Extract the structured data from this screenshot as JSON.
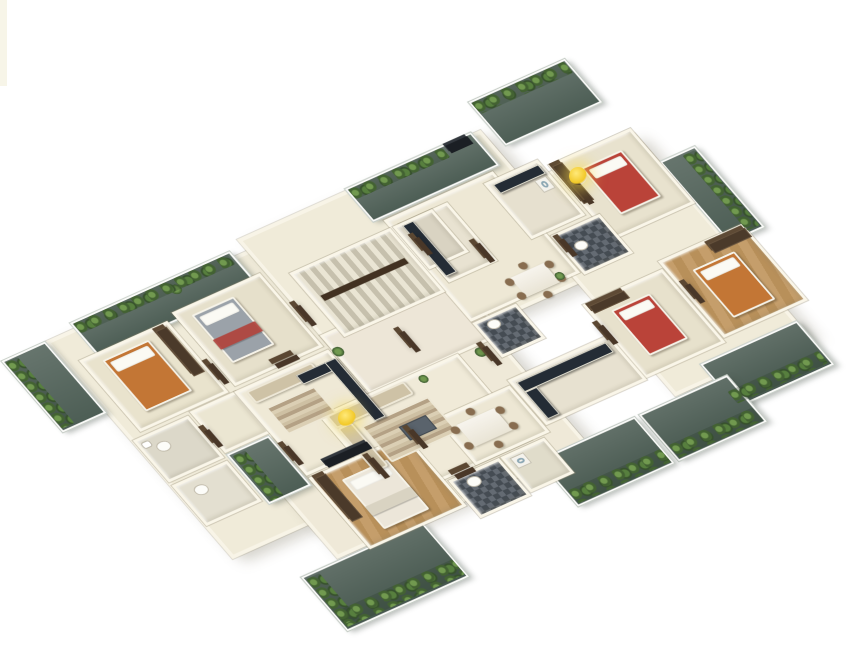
{
  "scene": {
    "kind": "isometric-3d-floor-plan-rendering",
    "palette": {
      "background": "#ffffff",
      "wall": "#f8f4e6",
      "floor_cream": "#f0ebd8",
      "balcony_deck": "#46584f",
      "foliage": "#4e7637",
      "wood_floor": "#c39a63",
      "counter_dark": "#232c36",
      "bed_red": "#c24136",
      "bed_orange": "#c9752e",
      "bed_grey": "#9aa2aa",
      "door_brown": "#4a3726",
      "light_accent": "#f2c928"
    },
    "projection": {
      "a": 0.84,
      "b": -0.378,
      "c": 0.647,
      "d": 0.75,
      "tx": -41,
      "ty": 323
    },
    "blocks": [
      {
        "name": "slab-left",
        "kind": "base",
        "x": 60,
        "y": 55,
        "w": 250,
        "h": 290,
        "floor": "#f0ebd8"
      },
      {
        "name": "slab-top",
        "kind": "base",
        "x": 300,
        "y": 40,
        "w": 290,
        "h": 190,
        "floor": "#f0ebd8"
      },
      {
        "name": "slab-right",
        "kind": "base",
        "x": 560,
        "y": 110,
        "w": 160,
        "h": 270,
        "floor": "#f0ebd8"
      },
      {
        "name": "slab-bottom",
        "kind": "base",
        "x": 150,
        "y": 240,
        "w": 300,
        "h": 150,
        "floor": "#efe9d6"
      },
      {
        "name": "balcony-top",
        "kind": "balcony",
        "x": 600,
        "y": 8,
        "w": 115,
        "h": 58,
        "floor": "#4c5e55"
      },
      {
        "name": "balcony-upper-left-west",
        "kind": "balcony",
        "x": 95,
        "y": 48,
        "w": 190,
        "h": 44,
        "floor": "#4c5e55"
      },
      {
        "name": "balcony-upper-left-east",
        "kind": "balcony",
        "x": 430,
        "y": 38,
        "w": 150,
        "h": 44,
        "floor": "#4c5e55"
      },
      {
        "name": "balcony-left",
        "kind": "balcony",
        "x": 8,
        "y": 55,
        "w": 52,
        "h": 95,
        "floor": "#4c5e55"
      },
      {
        "name": "balcony-right-upper",
        "kind": "balcony",
        "x": 720,
        "y": 148,
        "w": 42,
        "h": 108,
        "floor": "#4c5e55"
      },
      {
        "name": "balcony-right",
        "kind": "balcony",
        "x": 605,
        "y": 360,
        "w": 115,
        "h": 58,
        "floor": "#46584f"
      },
      {
        "name": "balcony-lower-right-east",
        "kind": "balcony",
        "x": 515,
        "y": 382,
        "w": 105,
        "h": 62,
        "floor": "#46584f"
      },
      {
        "name": "balcony-lower-right-west",
        "kind": "balcony",
        "x": 395,
        "y": 382,
        "w": 115,
        "h": 62,
        "floor": "#46584f"
      },
      {
        "name": "balcony-bottom",
        "kind": "balcony",
        "x": 105,
        "y": 392,
        "w": 145,
        "h": 72,
        "floor": "#46584f"
      },
      {
        "name": "balcony-niche",
        "kind": "balcony",
        "x": 132,
        "y": 242,
        "w": 50,
        "h": 66,
        "floor": "#4c5e55"
      },
      {
        "name": "corridor",
        "kind": "room",
        "x": 300,
        "y": 168,
        "w": 160,
        "h": 78,
        "floor": "#eee6d6"
      },
      {
        "name": "hall-top",
        "kind": "room",
        "x": 440,
        "y": 85,
        "w": 130,
        "h": 135,
        "floor": "#eee8d3"
      },
      {
        "name": "entry-left",
        "kind": "room",
        "x": 132,
        "y": 185,
        "w": 55,
        "h": 55,
        "floor": "#ece6d0"
      },
      {
        "name": "living-room-1",
        "kind": "room",
        "x": 185,
        "y": 185,
        "w": 112,
        "h": 112,
        "floor": "#efe9d4"
      },
      {
        "name": "living-room-2",
        "kind": "room",
        "x": 240,
        "y": 245,
        "w": 165,
        "h": 115,
        "floor": "#f0ead6"
      },
      {
        "name": "dining-room",
        "kind": "room",
        "x": 338,
        "y": 298,
        "w": 88,
        "h": 62,
        "floor": "#ede7d2"
      },
      {
        "name": "bedroom-1",
        "kind": "room",
        "x": 75,
        "y": 88,
        "w": 105,
        "h": 95,
        "floor": "#eae3cb"
      },
      {
        "name": "bedroom-2",
        "kind": "room",
        "x": 190,
        "y": 82,
        "w": 105,
        "h": 98,
        "floor": "#e7e0c9"
      },
      {
        "name": "bedroom-3",
        "kind": "room",
        "x": 185,
        "y": 300,
        "w": 115,
        "h": 95,
        "tex": "wood"
      },
      {
        "name": "bedroom-4",
        "kind": "room",
        "x": 622,
        "y": 103,
        "w": 98,
        "h": 100,
        "floor": "#e9e2cc"
      },
      {
        "name": "bedroom-5",
        "kind": "room",
        "x": 645,
        "y": 243,
        "w": 100,
        "h": 102,
        "tex": "wood"
      },
      {
        "name": "bedroom-6",
        "kind": "room",
        "x": 548,
        "y": 252,
        "w": 95,
        "h": 98,
        "floor": "#e8e1ca"
      },
      {
        "name": "kitchen-top-1",
        "kind": "room",
        "x": 450,
        "y": 95,
        "w": 58,
        "h": 78,
        "floor": "#e8e2cf"
      },
      {
        "name": "kitchen-top-2",
        "kind": "room",
        "x": 553,
        "y": 93,
        "w": 64,
        "h": 74,
        "floor": "#e6e0cd"
      },
      {
        "name": "kitchen-right",
        "kind": "room",
        "x": 428,
        "y": 292,
        "w": 120,
        "h": 60,
        "floor": "#e7e1ce"
      },
      {
        "name": "bathroom-1",
        "kind": "room",
        "x": 62,
        "y": 188,
        "w": 66,
        "h": 56,
        "floor": "#dcd8c8"
      },
      {
        "name": "bathroom-2",
        "kind": "room",
        "x": 62,
        "y": 248,
        "w": 66,
        "h": 54,
        "floor": "#e3dfcf"
      },
      {
        "name": "bathroom-3",
        "kind": "room",
        "x": 303,
        "y": 363,
        "w": 60,
        "h": 50,
        "tex": "tile"
      },
      {
        "name": "utility-room",
        "kind": "room",
        "x": 365,
        "y": 363,
        "w": 52,
        "h": 47,
        "floor": "#e0dcc9"
      },
      {
        "name": "bathroom-4",
        "kind": "room",
        "x": 572,
        "y": 172,
        "w": 58,
        "h": 52,
        "tex": "tile"
      },
      {
        "name": "bathroom-5",
        "kind": "room",
        "x": 440,
        "y": 222,
        "w": 52,
        "h": 46,
        "tex": "tile"
      },
      {
        "name": "stair-core",
        "kind": "room",
        "x": 320,
        "y": 95,
        "w": 120,
        "h": 85,
        "tex": "stairs"
      },
      {
        "name": "lift",
        "kind": "room",
        "x": 443,
        "y": 95,
        "w": 47,
        "h": 57,
        "floor": "#d9d3c1"
      }
    ],
    "furniture": [
      {
        "name": "bed-orange-west",
        "kind": "bed",
        "x": 95,
        "y": 98,
        "w": 55,
        "h": 68,
        "color": "#c9752e"
      },
      {
        "name": "bed-grey",
        "kind": "bed",
        "x": 205,
        "y": 93,
        "w": 50,
        "h": 64,
        "color": "#9aa2aa"
      },
      {
        "name": "bed-grey-throw",
        "kind": "throw",
        "x": 205,
        "y": 126,
        "w": 50,
        "h": 13,
        "color": "#b8413a"
      },
      {
        "name": "bed-red-north",
        "kind": "bed",
        "x": 648,
        "y": 120,
        "w": 48,
        "h": 62,
        "color": "#c24136"
      },
      {
        "name": "bed-orange-east",
        "kind": "bed",
        "x": 668,
        "y": 266,
        "w": 50,
        "h": 64,
        "color": "#c9752e"
      },
      {
        "name": "bed-red-south",
        "kind": "bed",
        "x": 568,
        "y": 270,
        "w": 46,
        "h": 60,
        "color": "#c24136"
      },
      {
        "name": "bed-white",
        "kind": "bed",
        "x": 212,
        "y": 316,
        "w": 54,
        "h": 66,
        "color": "#ece6d8"
      },
      {
        "name": "bed-white-throw",
        "kind": "throw",
        "x": 212,
        "y": 352,
        "w": 54,
        "h": 12,
        "color": "#d9d2bf"
      },
      {
        "name": "wardrobe",
        "kind": "wardrobe",
        "x": 162,
        "y": 93,
        "w": 13,
        "h": 60
      },
      {
        "name": "wardrobe",
        "kind": "wardrobe",
        "x": 190,
        "y": 303,
        "w": 13,
        "h": 58
      },
      {
        "name": "wardrobe",
        "kind": "wardrobe",
        "x": 700,
        "y": 248,
        "w": 44,
        "h": 12
      },
      {
        "name": "wardrobe",
        "kind": "wardrobe",
        "x": 552,
        "y": 256,
        "w": 42,
        "h": 10
      },
      {
        "name": "wardrobe",
        "kind": "wardrobe",
        "x": 624,
        "y": 106,
        "w": 12,
        "h": 50
      },
      {
        "name": "sofa",
        "kind": "sofa",
        "x": 195,
        "y": 190,
        "w": 78,
        "h": 16
      },
      {
        "name": "sofa-l-back",
        "kind": "sofa",
        "x": 246,
        "y": 248,
        "w": 92,
        "h": 17
      },
      {
        "name": "sofa-l-arm",
        "kind": "sofa",
        "x": 246,
        "y": 265,
        "w": 17,
        "h": 58
      },
      {
        "name": "rug",
        "kind": "rug",
        "x": 200,
        "y": 214,
        "w": 58,
        "h": 36
      },
      {
        "name": "rug",
        "kind": "rug",
        "x": 268,
        "y": 273,
        "w": 80,
        "h": 48
      },
      {
        "name": "coffee-table",
        "kind": "coffee",
        "x": 300,
        "y": 290,
        "w": 32,
        "h": 18
      },
      {
        "name": "dining-set",
        "kind": "dining",
        "x": 338,
        "y": 302,
        "w": 70,
        "h": 52
      },
      {
        "name": "dining-set",
        "kind": "dining",
        "x": 495,
        "y": 185,
        "w": 62,
        "h": 46
      },
      {
        "name": "kitchen-counter",
        "kind": "counter",
        "x": 452,
        "y": 98,
        "w": 13,
        "h": 68
      },
      {
        "name": "kitchen-counter",
        "kind": "counter",
        "x": 560,
        "y": 98,
        "w": 54,
        "h": 12
      },
      {
        "name": "kitchen-counter",
        "kind": "counter",
        "x": 250,
        "y": 196,
        "w": 46,
        "h": 12
      },
      {
        "name": "kitchen-counter",
        "kind": "counter",
        "x": 284,
        "y": 196,
        "w": 13,
        "h": 78
      },
      {
        "name": "kitchen-counter",
        "kind": "counter",
        "x": 434,
        "y": 298,
        "w": 106,
        "h": 13
      },
      {
        "name": "kitchen-counter",
        "kind": "counter",
        "x": 434,
        "y": 311,
        "w": 14,
        "h": 36
      },
      {
        "name": "tv-panel",
        "kind": "tv",
        "x": 548,
        "y": 40,
        "w": 26,
        "h": 10
      },
      {
        "name": "tv-unit",
        "kind": "tv",
        "x": 210,
        "y": 290,
        "w": 52,
        "h": 9
      },
      {
        "name": "toilet",
        "kind": "toilet",
        "x": 78,
        "y": 202,
        "w": 13,
        "h": 10
      },
      {
        "name": "wash-basin",
        "kind": "basin",
        "x": 66,
        "y": 194,
        "w": 10,
        "h": 8
      },
      {
        "name": "toilet",
        "kind": "toilet",
        "x": 78,
        "y": 260,
        "w": 13,
        "h": 10
      },
      {
        "name": "toilet",
        "kind": "toilet",
        "x": 318,
        "y": 370,
        "w": 13,
        "h": 10
      },
      {
        "name": "toilet",
        "kind": "toilet",
        "x": 585,
        "y": 190,
        "w": 12,
        "h": 9
      },
      {
        "name": "toilet",
        "kind": "toilet",
        "x": 452,
        "y": 228,
        "w": 12,
        "h": 9
      },
      {
        "name": "washing-machine",
        "kind": "washer",
        "x": 372,
        "y": 368,
        "w": 16,
        "h": 14
      },
      {
        "name": "fridge",
        "kind": "washer",
        "x": 598,
        "y": 112,
        "w": 14,
        "h": 16
      },
      {
        "name": "door-frame",
        "kind": "door",
        "x": 182,
        "y": 148,
        "w": 6,
        "h": 26
      },
      {
        "name": "door-frame",
        "kind": "door",
        "x": 240,
        "y": 176,
        "w": 26,
        "h": 6
      },
      {
        "name": "door-frame",
        "kind": "door",
        "x": 130,
        "y": 210,
        "w": 6,
        "h": 22
      },
      {
        "name": "door-frame",
        "kind": "door",
        "x": 186,
        "y": 260,
        "w": 6,
        "h": 24
      },
      {
        "name": "door-frame",
        "kind": "door",
        "x": 305,
        "y": 298,
        "w": 6,
        "h": 24
      },
      {
        "name": "door-frame",
        "kind": "door",
        "x": 312,
        "y": 360,
        "w": 22,
        "h": 6
      },
      {
        "name": "door-frame",
        "kind": "door",
        "x": 250,
        "y": 308,
        "w": 6,
        "h": 26
      },
      {
        "name": "door-frame",
        "kind": "door",
        "x": 500,
        "y": 148,
        "w": 6,
        "h": 24
      },
      {
        "name": "door-frame",
        "kind": "door",
        "x": 628,
        "y": 133,
        "w": 6,
        "h": 26
      },
      {
        "name": "door-frame",
        "kind": "door",
        "x": 575,
        "y": 180,
        "w": 6,
        "h": 22
      },
      {
        "name": "door-frame",
        "kind": "door",
        "x": 452,
        "y": 116,
        "w": 6,
        "h": 22
      },
      {
        "name": "door-frame",
        "kind": "door",
        "x": 650,
        "y": 278,
        "w": 6,
        "h": 24
      },
      {
        "name": "door-frame",
        "kind": "door",
        "x": 545,
        "y": 280,
        "w": 6,
        "h": 24
      },
      {
        "name": "door-frame",
        "kind": "door",
        "x": 430,
        "y": 250,
        "w": 6,
        "h": 24
      },
      {
        "name": "door-frame",
        "kind": "door",
        "x": 370,
        "y": 200,
        "w": 6,
        "h": 26
      },
      {
        "name": "door-frame",
        "kind": "door",
        "x": 300,
        "y": 130,
        "w": 6,
        "h": 26
      },
      {
        "name": "stair-handrail",
        "kind": "rail",
        "x": 330,
        "y": 130,
        "w": 100,
        "h": 7,
        "color": "#43311f"
      },
      {
        "name": "planter",
        "kind": "plants",
        "x": 602,
        "y": 10,
        "w": 110,
        "h": 15
      },
      {
        "name": "planter",
        "kind": "plants",
        "x": 432,
        "y": 40,
        "w": 112,
        "h": 13
      },
      {
        "name": "planter",
        "kind": "plants",
        "x": 97,
        "y": 50,
        "w": 184,
        "h": 13
      },
      {
        "name": "planter",
        "kind": "plants",
        "x": 10,
        "y": 58,
        "w": 15,
        "h": 88
      },
      {
        "name": "planter",
        "kind": "plants",
        "x": 744,
        "y": 152,
        "w": 15,
        "h": 100
      },
      {
        "name": "planter",
        "kind": "plants",
        "x": 608,
        "y": 398,
        "w": 108,
        "h": 16
      },
      {
        "name": "planter",
        "kind": "plants",
        "x": 518,
        "y": 424,
        "w": 100,
        "h": 17
      },
      {
        "name": "planter",
        "kind": "plants",
        "x": 398,
        "y": 424,
        "w": 110,
        "h": 17
      },
      {
        "name": "planter",
        "kind": "plants",
        "x": 108,
        "y": 440,
        "w": 140,
        "h": 20
      },
      {
        "name": "planter",
        "kind": "plants",
        "x": 108,
        "y": 396,
        "w": 16,
        "h": 60
      },
      {
        "name": "planter",
        "kind": "plants",
        "x": 136,
        "y": 246,
        "w": 15,
        "h": 60
      },
      {
        "name": "plant-pot",
        "kind": "pot",
        "x": 298,
        "y": 186,
        "w": 12,
        "h": 12
      },
      {
        "name": "plant-pot",
        "kind": "pot",
        "x": 420,
        "y": 248,
        "w": 12,
        "h": 12
      },
      {
        "name": "plant-pot",
        "kind": "pot",
        "x": 352,
        "y": 250,
        "w": 10,
        "h": 10
      },
      {
        "name": "plant-pot",
        "kind": "pot",
        "x": 545,
        "y": 210,
        "w": 10,
        "h": 10
      },
      {
        "name": "plant-pot",
        "kind": "pot",
        "x": 205,
        "y": 56,
        "w": 12,
        "h": 12
      }
    ],
    "lights": [
      {
        "name": "ceiling-light-glow",
        "x": 578,
        "y": 176
      },
      {
        "name": "ceiling-light-glow",
        "x": 347,
        "y": 418
      }
    ]
  }
}
